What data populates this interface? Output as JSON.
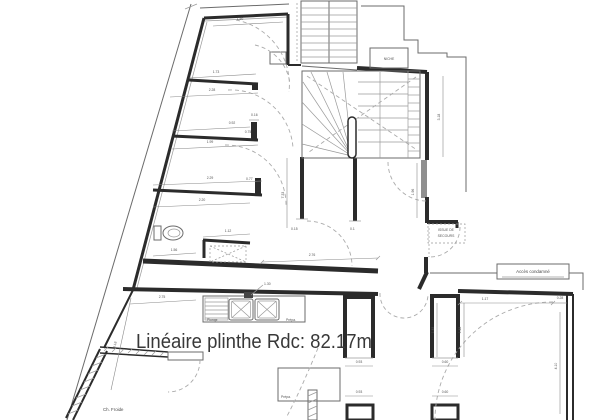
{
  "title": {
    "label": "Linéaire plinthe Rdc: 82.17m"
  },
  "labels": {
    "niche": "NICHE",
    "issue_line1": "ISSUE DE",
    "issue_line2": "SECOURS",
    "acces_condamne": "Accès condamné",
    "ch_froide": "Ch. Froide",
    "plonge": "Plonge",
    "prepa_counter": "Prépa.",
    "prepa_table": "Prépa."
  },
  "dims": {
    "d150": "1.50",
    "d173": "1.73",
    "d228": "2.28",
    "d092": "0.92",
    "d075": "0.75",
    "d199": "1.99",
    "d229": "2.29",
    "d220": "2.20",
    "d112": "1.12",
    "d156": "1.56",
    "d276": "2.76",
    "d275": "2.75",
    "d733": "7.33",
    "d196": "1.96",
    "d318": "3.18",
    "d418": "4.18",
    "d130": "1.30",
    "d117": "1.17",
    "d028": "0.28",
    "d148a": "1.48",
    "d148b": "1.48",
    "d060a": "0.60",
    "d060b": "0.60",
    "d093a": "0.93",
    "d093b": "0.93",
    "d410": "4.10",
    "d016": "0.16",
    "d077": "0.77",
    "d015": "0.15",
    "d010": "0.1"
  },
  "colors": {
    "background": "#ffffff",
    "wall": "#2b2b2b",
    "thin_line": "#6b6b6b",
    "dashed_arc": "#ababab",
    "text": "#383838",
    "door_leaf": "#8f8f8f"
  }
}
